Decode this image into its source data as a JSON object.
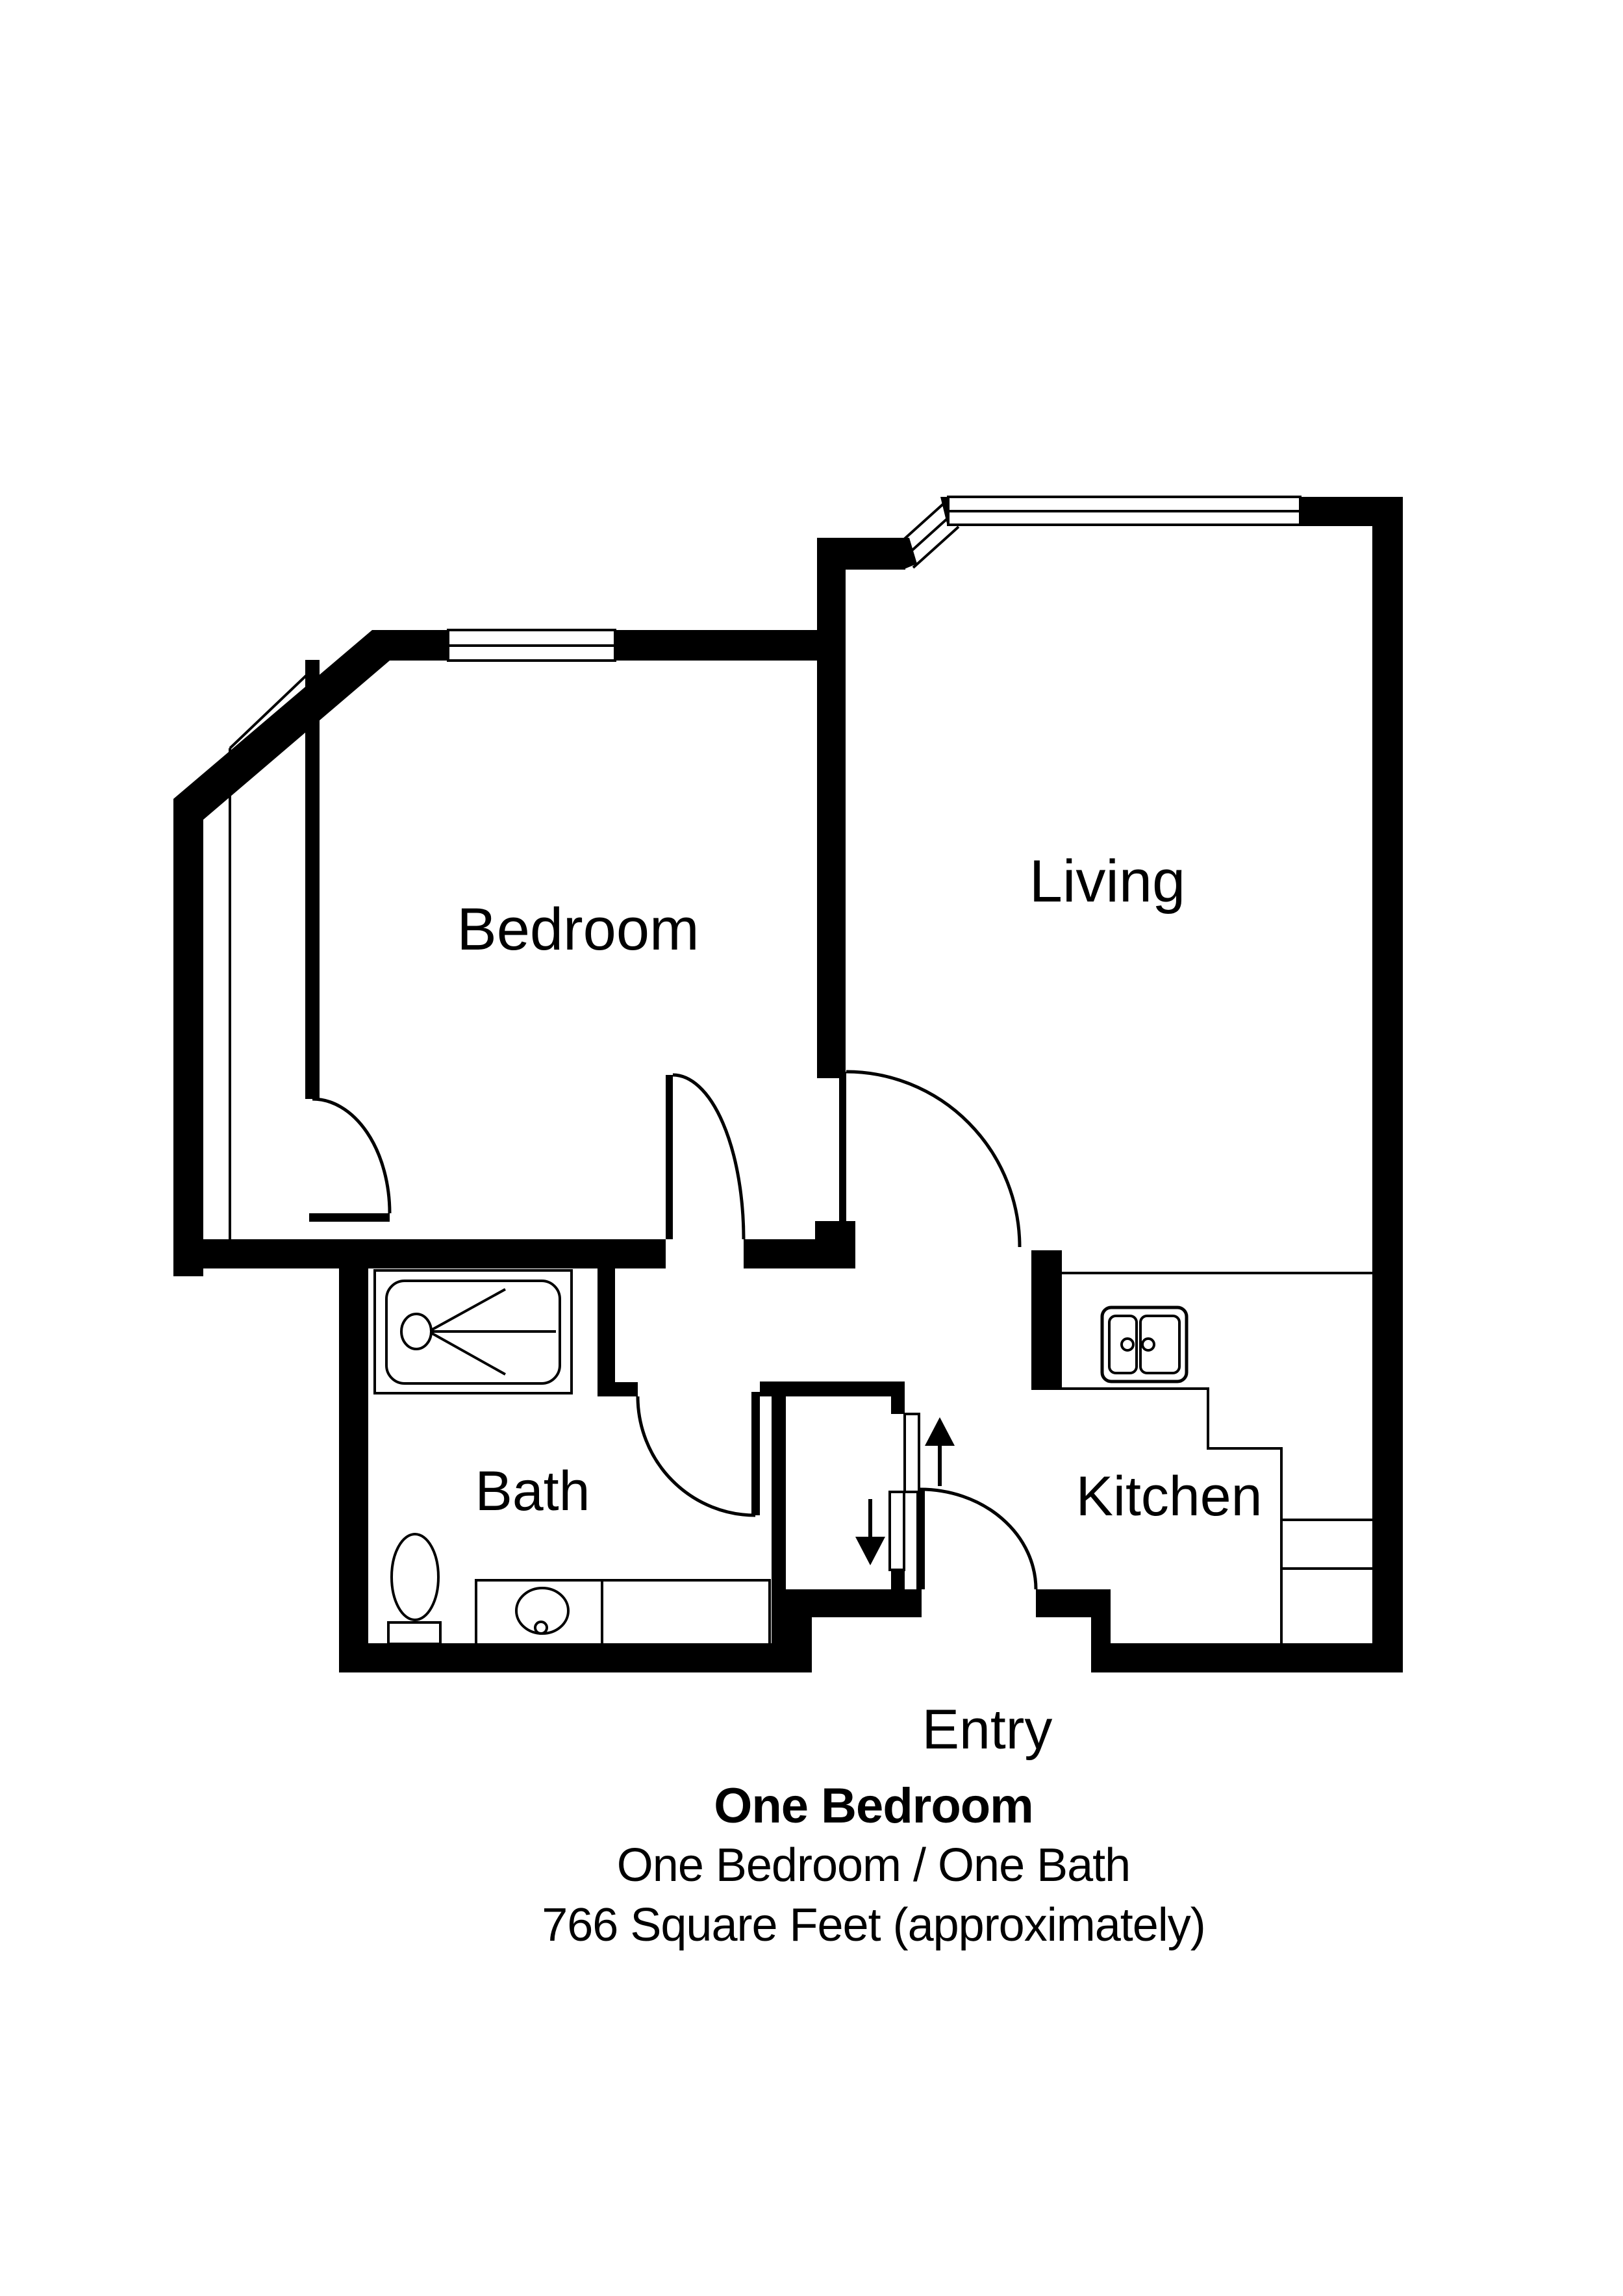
{
  "plan": {
    "type": "apartment-floor-plan",
    "colors": {
      "wall": "#000000",
      "background": "#ffffff"
    },
    "rooms": {
      "bedroom": {
        "label": "Bedroom"
      },
      "living": {
        "label": "Living"
      },
      "bath": {
        "label": "Bath"
      },
      "kitchen": {
        "label": "Kitchen"
      },
      "entry": {
        "label": "Entry"
      }
    },
    "fixtures": [
      "shower-symbol",
      "toilet-symbol",
      "vanity-sink-symbol",
      "kitchen-double-sink-symbol",
      "kitchen-counter",
      "closet-sliding-doors"
    ],
    "windows": [
      "bedroom-window",
      "living-bay-angled-window",
      "living-top-window"
    ],
    "doors": [
      "bedroom-closet-door",
      "bedroom-hall-door",
      "living-hall-door",
      "bath-door",
      "entry-door",
      "closet-bypass-doors"
    ],
    "arrows": [
      "slide-up-arrow",
      "slide-down-arrow"
    ]
  },
  "title": {
    "line1": "One Bedroom",
    "line2": "One Bedroom / One Bath",
    "line3": "766 Square Feet (approximately)"
  }
}
